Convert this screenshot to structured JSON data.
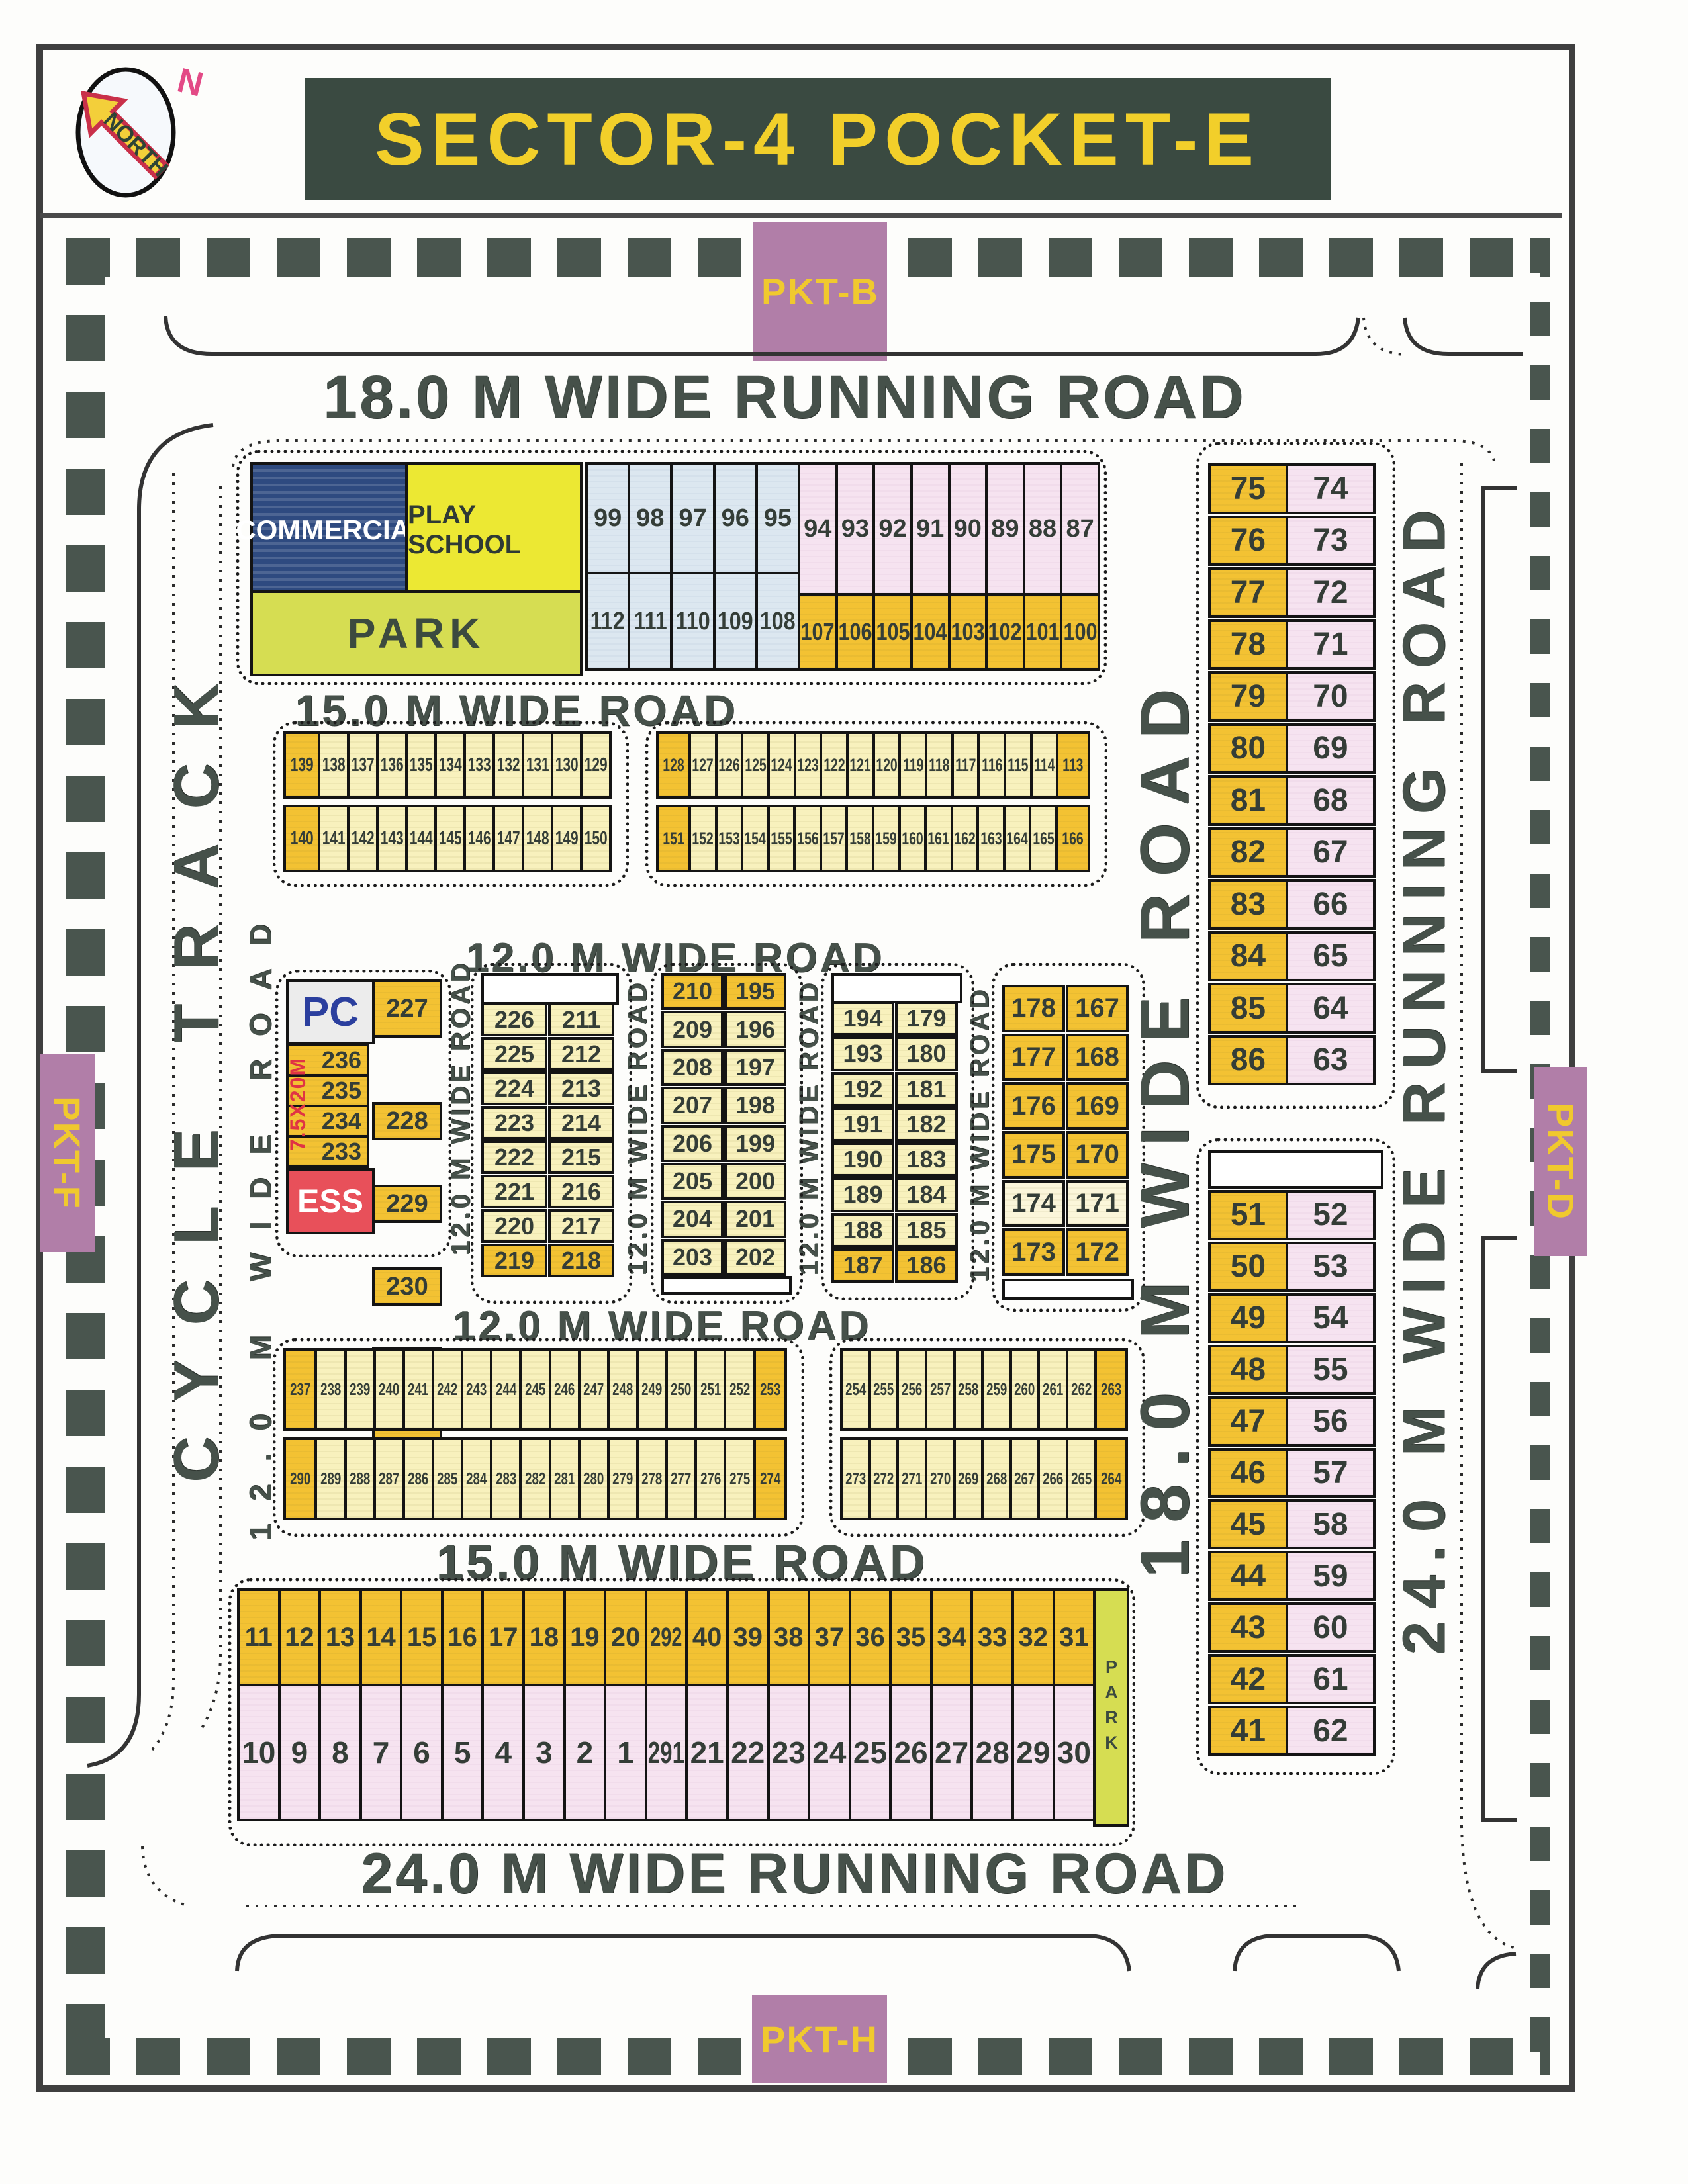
{
  "title": "SECTOR-4 POCKET-E",
  "north": {
    "label": "NORTH",
    "letter": "N"
  },
  "pockets": {
    "top": "PKT-B",
    "left": "PKT-F",
    "right": "PKT-D",
    "bottom": "PKT-H"
  },
  "roads": {
    "top": "18.0 M WIDE RUNNING ROAD",
    "road15_upper": "15.0 M WIDE ROAD",
    "road12_upper": "12.0 M WIDE ROAD",
    "road12_lower": "12.0 M WIDE ROAD",
    "road15_lower": "15.0 M WIDE ROAD",
    "bottom": "24.0 M WIDE RUNNING ROAD",
    "cycle_track": "CYCLE TRACK",
    "left_vertical": "12.0 M WIDE ROAD",
    "mid_vertical": "18.0 M WIDE ROAD",
    "right_vertical": "24.0 M WIDE RUNNING ROAD",
    "inner_vertical": "12.0 M WIDE ROAD"
  },
  "top_block": {
    "commercial": "COMMERCIAL",
    "play_school": "PLAY SCHOOL",
    "park": "PARK",
    "blue_top": [
      "99",
      "98",
      "97",
      "96",
      "95"
    ],
    "blue_bottom": [
      "112",
      "111",
      "110",
      "109",
      "108"
    ],
    "pink_top": [
      "94",
      "93",
      "92",
      "91",
      "90",
      "89",
      "88",
      "87"
    ],
    "orange_bottom": [
      "107",
      "106",
      "105",
      "104",
      "103",
      "102",
      "101",
      "100"
    ]
  },
  "band15": {
    "left_top": [
      "139|hl|wide",
      "138",
      "137",
      "136",
      "135",
      "134",
      "133",
      "132",
      "131",
      "130",
      "129"
    ],
    "left_bottom": [
      "140|hl|wide",
      "141",
      "142",
      "143",
      "144",
      "145",
      "146",
      "147",
      "148",
      "149",
      "150"
    ],
    "right_top": [
      "128|hl|wide",
      "127",
      "126",
      "125",
      "124",
      "123",
      "122",
      "121",
      "120",
      "119",
      "118",
      "117",
      "116",
      "115",
      "114",
      "113|hl|wide"
    ],
    "right_bottom": [
      "151|hl|wide",
      "152",
      "153",
      "154",
      "155",
      "156",
      "157",
      "158",
      "159",
      "160",
      "161",
      "162",
      "163",
      "164",
      "165",
      "166|hl|wide"
    ]
  },
  "mid": {
    "pc": "PC",
    "ess": "ESS",
    "size_note": "7.5X20M",
    "c1_left": [
      "236",
      "235",
      "234",
      "233"
    ],
    "c2_left": [
      "226",
      "225",
      "224",
      "223",
      "222",
      "221",
      "220",
      "219|hl"
    ],
    "c2_right": [
      "211",
      "212",
      "213",
      "214",
      "215",
      "216",
      "217",
      "218|hl"
    ],
    "c3_left": [
      "210|hl",
      "209",
      "208",
      "207",
      "206",
      "205",
      "204",
      "203"
    ],
    "c3_right": [
      "195|hl",
      "196",
      "197",
      "198",
      "199",
      "200",
      "201",
      "202"
    ],
    "c4_left": [
      "194",
      "193",
      "192",
      "191",
      "190",
      "189",
      "188",
      "187|hl"
    ],
    "c4_right": [
      "179",
      "180",
      "181",
      "182",
      "183",
      "184",
      "185",
      "186|hl"
    ],
    "c5_left": [
      "178",
      "177",
      "176",
      "175",
      "174|white",
      "173"
    ],
    "c5_right": [
      "167",
      "168",
      "169",
      "170",
      "171|white",
      "172"
    ]
  },
  "band12": {
    "left_top": [
      "237|hl|wide",
      "238",
      "239",
      "240",
      "241",
      "242",
      "243",
      "244",
      "245",
      "246",
      "247",
      "248",
      "249",
      "250",
      "251",
      "252",
      "253|hl|wide"
    ],
    "left_bottom": [
      "290|hl|wide",
      "289",
      "288",
      "287",
      "286",
      "285",
      "284",
      "283",
      "282",
      "281",
      "280",
      "279",
      "278",
      "277",
      "276",
      "275",
      "274|hl|wide"
    ],
    "right_top": [
      "254",
      "255",
      "256",
      "257",
      "258",
      "259",
      "260",
      "261",
      "262",
      "263|hl|wide"
    ],
    "right_bottom": [
      "273",
      "272",
      "271",
      "270",
      "269",
      "268",
      "267",
      "266",
      "265",
      "264|hl|wide"
    ]
  },
  "band24": {
    "top": [
      "11",
      "12",
      "13",
      "14",
      "15",
      "16",
      "17",
      "18",
      "19",
      "20",
      "292|narrow",
      "40",
      "39",
      "38",
      "37",
      "36",
      "35",
      "34",
      "33",
      "32",
      "31"
    ],
    "bottom": [
      "10",
      "9",
      "8",
      "7",
      "6",
      "5",
      "4",
      "3",
      "2",
      "1",
      "291|narrow",
      "21",
      "22",
      "23",
      "24",
      "25",
      "26",
      "27",
      "28",
      "29",
      "30"
    ],
    "park_vertical": "PARK"
  },
  "right_blocks": {
    "b1_left": [
      "75",
      "76",
      "77",
      "78",
      "79",
      "80",
      "81",
      "82",
      "83",
      "84",
      "85",
      "86"
    ],
    "b1_right": [
      "74",
      "73",
      "72",
      "71",
      "70",
      "69",
      "68",
      "67",
      "66",
      "65",
      "64",
      "63"
    ],
    "b2_left": [
      "51",
      "50",
      "49",
      "48",
      "47",
      "46",
      "45",
      "44",
      "43",
      "42",
      "41"
    ],
    "b2_right": [
      "52",
      "53",
      "54",
      "55",
      "56",
      "57",
      "58",
      "59",
      "60",
      "61",
      "62"
    ]
  }
}
